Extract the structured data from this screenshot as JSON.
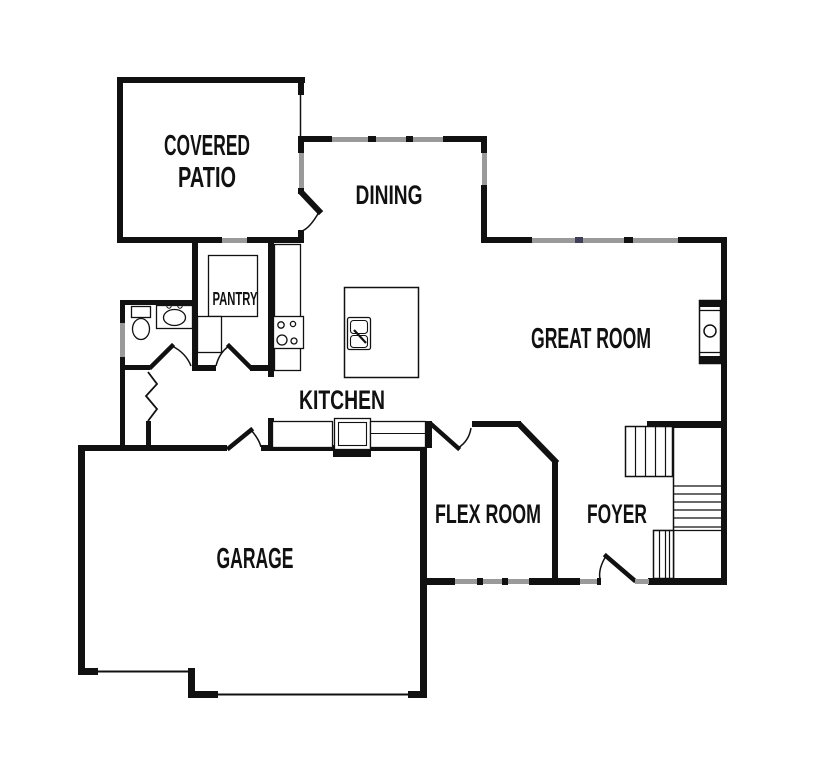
{
  "title": "First floor plan",
  "rooms": {
    "covered_patio": {
      "label_line1": "COVERED",
      "label_line2": "PATIO"
    },
    "dining": {
      "label": "DINING"
    },
    "pantry": {
      "label": "PANTRY"
    },
    "kitchen": {
      "label": "KITCHEN"
    },
    "great_room": {
      "label": "GREAT ROOM"
    },
    "garage": {
      "label": "GARAGE"
    },
    "flex_room": {
      "label": "FLEX ROOM"
    },
    "foyer": {
      "label": "FOYER"
    }
  },
  "colors": {
    "wall": "#111111",
    "window": "#9a9a9a",
    "mullion": "#3f3f58",
    "background": "#ffffff"
  }
}
